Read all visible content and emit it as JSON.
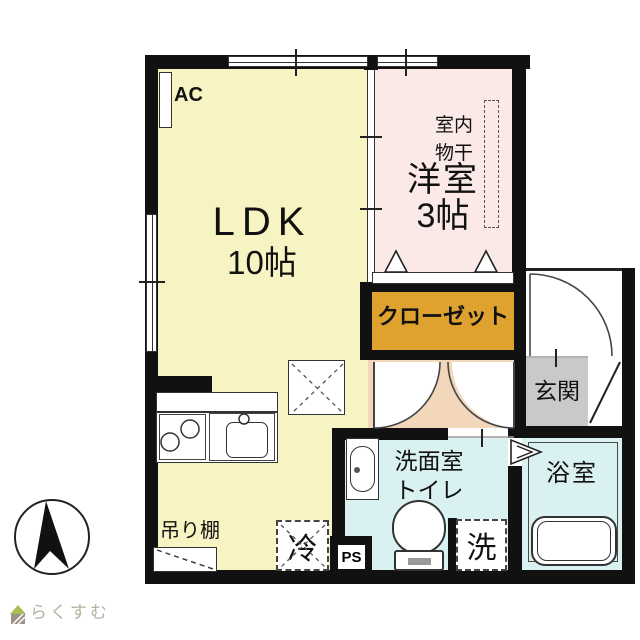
{
  "floorplan": {
    "rooms": {
      "ldk": {
        "name": "LDK",
        "size": "10帖"
      },
      "western_room": {
        "name": "洋室",
        "size": "3帖",
        "indoor_drying_line1": "室内",
        "indoor_drying_line2": "物干"
      },
      "closet": {
        "name": "クローゼット"
      },
      "entrance": {
        "name": "玄関"
      },
      "washroom_toilet": {
        "line1": "洗面室",
        "line2": "トイレ"
      },
      "bathroom": {
        "name": "浴室"
      }
    },
    "fixtures": {
      "air_conditioner": "AC",
      "refrigerator": "冷",
      "washing_machine": "洗",
      "pipe_space": "PS",
      "hanging_shelf": "吊り棚"
    },
    "colors": {
      "ldk": "#f8f3c2",
      "western_room": "#fae9e7",
      "closet": "#dfa22f",
      "hallway": "#f3d7ba",
      "entrance": "#c9c9c9",
      "wet_area": "#d9f2f1",
      "wall": "#111111",
      "watermark_text": "#b7b0a1",
      "watermark_roof": "#a8bf55"
    },
    "watermark": {
      "brand": "らくすむ"
    }
  }
}
